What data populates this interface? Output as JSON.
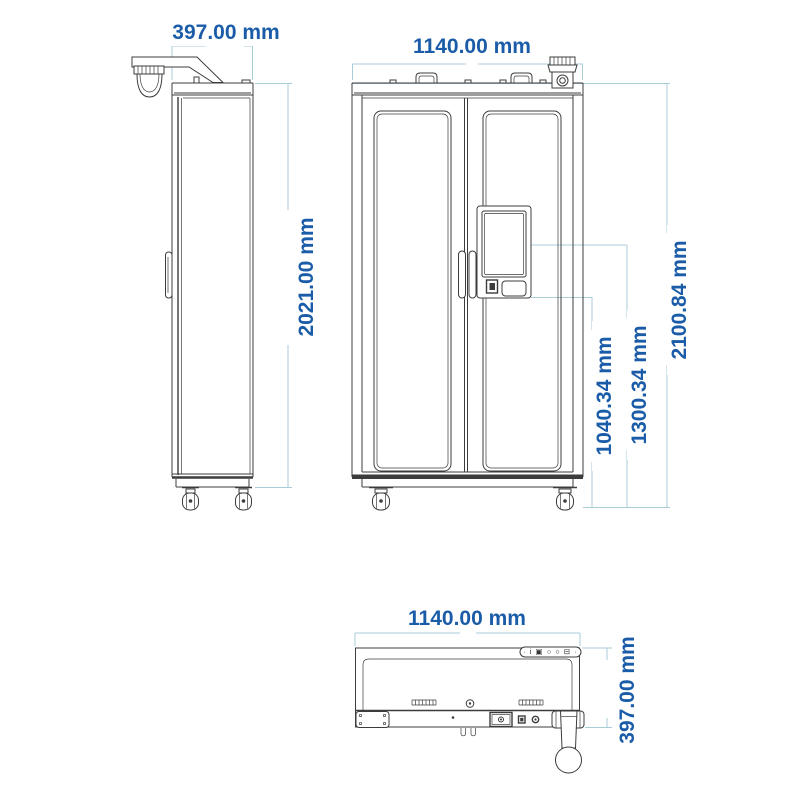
{
  "colors": {
    "dimension_text": "#1a5ca8",
    "dimension_line": "#a9cdd7",
    "drawing_line": "#3c3c3c",
    "canvas_bg": "#ffffff"
  },
  "side_view": {
    "width_label": "397.00 mm",
    "height_label": "2021.00 mm"
  },
  "front_view": {
    "width_label": "1140.00 mm",
    "height_label": "2100.84 mm",
    "screen_center_height_label": "1300.34 mm",
    "terminal_bottom_height_label": "1040.34 mm"
  },
  "top_view": {
    "width_label": "1140.00 mm",
    "depth_label": "397.00 mm",
    "connector_icons": "· i ▣ ○ ○ ⊟ ·"
  }
}
